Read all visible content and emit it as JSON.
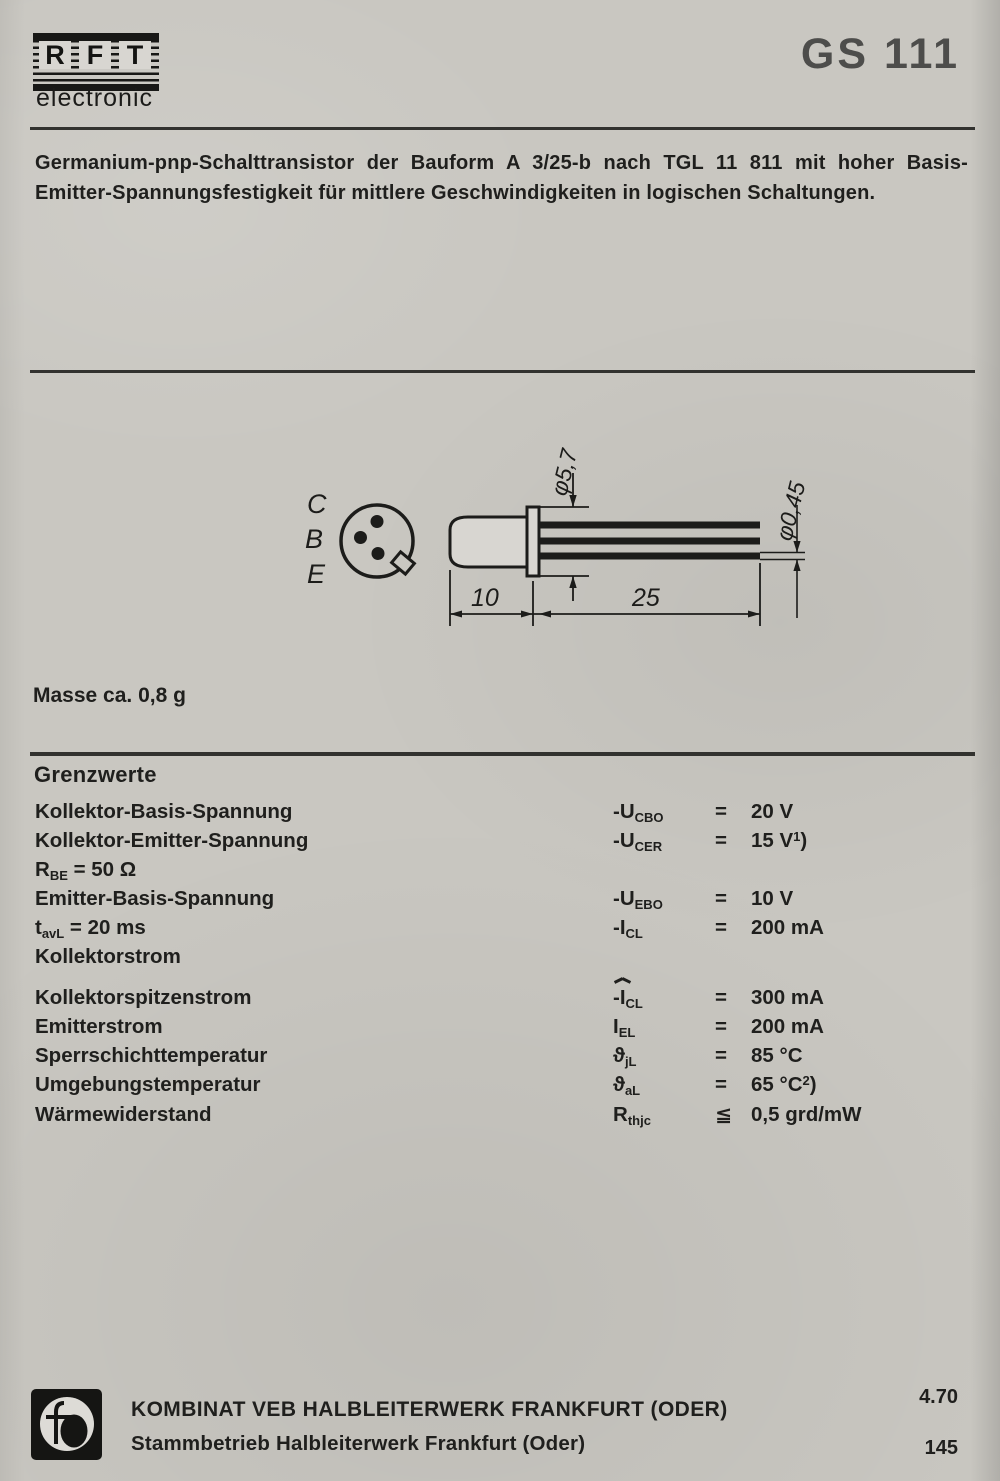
{
  "colors": {
    "paper": "#c9c7c1",
    "ink": "#1f1f1d",
    "title_gray": "#4d4d4b"
  },
  "header": {
    "logo_letters": [
      "R",
      "F",
      "T"
    ],
    "logo_sub": "electronic",
    "product": "GS 111"
  },
  "description": "Germanium-pnp-Schalttransistor der Bauform A 3/25-b nach TGL 11 811 mit hoher Basis-Emitter-Spannungsfestigkeit für mittlere Geschwindigkeiten in logischen Schaltungen.",
  "drawing": {
    "pin_labels": [
      "C",
      "B",
      "E"
    ],
    "dim_diameter_flange": "φ5,7",
    "dim_diameter_lead": "φ0,45",
    "dim_body_length": "10",
    "dim_lead_length": "25"
  },
  "mass_note": "Masse ca. 0,8 g",
  "grenzwerte": {
    "heading": "Grenzwerte",
    "rows": [
      {
        "label": "Kollektor-Basis-Spannung",
        "label_sub": "",
        "label_post": "",
        "sym": "-U",
        "sym_hat_letter": "",
        "sym_sub": "CBO",
        "rel": "=",
        "val": "20 V",
        "val_sup": "",
        "val_post": "",
        "gap": false
      },
      {
        "label": "Kollektor-Emitter-Spannung",
        "label_sub": "",
        "label_post": "",
        "sym": "-U",
        "sym_hat_letter": "",
        "sym_sub": "CER",
        "rel": "=",
        "val": "15 V",
        "val_sup": "1",
        "val_post": ")",
        "gap": false
      },
      {
        "label": "R",
        "label_sub": "BE",
        "label_post": " = 50 Ω",
        "sym": "",
        "sym_hat_letter": "",
        "sym_sub": "",
        "rel": "",
        "val": "",
        "val_sup": "",
        "val_post": "",
        "gap": false
      },
      {
        "label": "Emitter-Basis-Spannung",
        "label_sub": "",
        "label_post": "",
        "sym": "-U",
        "sym_hat_letter": "",
        "sym_sub": "EBO",
        "rel": "=",
        "val": "10 V",
        "val_sup": "",
        "val_post": "",
        "gap": false
      },
      {
        "label": "t",
        "label_sub": "avL",
        "label_post": " = 20 ms",
        "sym": "-I",
        "sym_hat_letter": "",
        "sym_sub": "CL",
        "rel": "=",
        "val": "200 mA",
        "val_sup": "",
        "val_post": "",
        "gap": false
      },
      {
        "label": "Kollektorstrom",
        "label_sub": "",
        "label_post": "",
        "sym": "",
        "sym_hat_letter": "",
        "sym_sub": "",
        "rel": "",
        "val": "",
        "val_sup": "",
        "val_post": "",
        "gap": false
      },
      {
        "label": "Kollektorspitzenstrom",
        "label_sub": "",
        "label_post": "",
        "sym": "-",
        "sym_hat_letter": "I",
        "sym_sub": "CL",
        "rel": "=",
        "val": "300 mA",
        "val_sup": "",
        "val_post": "",
        "gap": true
      },
      {
        "label": "Emitterstrom",
        "label_sub": "",
        "label_post": "",
        "sym": "I",
        "sym_hat_letter": "",
        "sym_sub": "EL",
        "rel": "=",
        "val": "200 mA",
        "val_sup": "",
        "val_post": "",
        "gap": false
      },
      {
        "label": "Sperrschichttemperatur",
        "label_sub": "",
        "label_post": "",
        "sym": "ϑ",
        "sym_hat_letter": "",
        "sym_sub": "jL",
        "rel": "=",
        "val": "85 °C",
        "val_sup": "",
        "val_post": "",
        "gap": false
      },
      {
        "label": "Umgebungstemperatur",
        "label_sub": "",
        "label_post": "",
        "sym": "ϑ",
        "sym_hat_letter": "",
        "sym_sub": "aL",
        "rel": "=",
        "val": "65 °C",
        "val_sup": "2",
        "val_post": ")",
        "gap": false
      },
      {
        "label": "Wärmewiderstand",
        "label_sub": "",
        "label_post": "",
        "sym": "R",
        "sym_hat_letter": "",
        "sym_sub": "thjc",
        "rel": "≦",
        "val": "0,5 grd/mW",
        "val_sup": "",
        "val_post": "",
        "gap": false
      }
    ]
  },
  "footer": {
    "company_line1": "KOMBINAT VEB HALBLEITERWERK FRANKFURT (ODER)",
    "company_line2": "Stammbetrieb Halbleiterwerk Frankfurt (Oder)",
    "date_code": "4.70",
    "page_number": "145"
  }
}
